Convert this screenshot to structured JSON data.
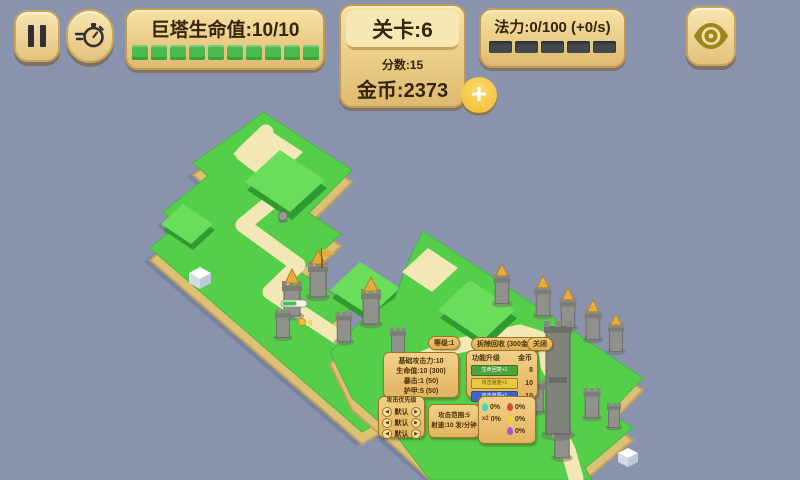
{
  "hud": {
    "tower_hp_label": "巨塔生命值:10/10",
    "level_label": "关卡:6",
    "score_label": "分数:15",
    "gold_label": "金币:2373",
    "mana_label": "法力:0/100 (+0/s)",
    "plus_glyph": "+"
  },
  "tooltip": {
    "level_pill": "等级:1",
    "demolish_label": "拆除回收 (300金币)",
    "close_label": "关闭",
    "stats": [
      "基础攻击力:10",
      "生命值:10 (300)",
      "暴击:1 (50)",
      "护甲:5 (50)"
    ],
    "upgrades": {
      "title": "功能升级",
      "cost_header": "金币",
      "items": [
        {
          "label": "生命回复+1",
          "cost": "8",
          "color": "#4CA53C"
        },
        {
          "label": "攻击速度+1",
          "cost": "10",
          "color": "#E8C93F"
        },
        {
          "label": "攻击范围+1",
          "cost": "10",
          "color": "#3E66C8"
        }
      ]
    },
    "priority": {
      "title": "攻击优先级",
      "rows": [
        "默认",
        "默认",
        "默认"
      ]
    },
    "range_lines": [
      "攻击范围:5",
      "射速:10 发/分钟"
    ],
    "effects": {
      "col1": [
        {
          "name": "ice",
          "prefix": "",
          "value": "0%"
        },
        {
          "name": "crit",
          "prefix": "x2",
          "value": "0%"
        }
      ],
      "col2": [
        {
          "name": "fire",
          "value": "0%"
        },
        {
          "name": "lightning",
          "value": "0%"
        },
        {
          "name": "poison",
          "value": "0%"
        }
      ]
    }
  },
  "map": {
    "floating_gold": "6"
  },
  "colors": {
    "background": "#8A93AE",
    "grass_top": "#55CE4A",
    "grass_raised": "#6ADE5A",
    "sand_path": "#F3E7B6",
    "cliff_sand": "#DCC077",
    "panel_gold": "#EDCF87",
    "hp_segment": "#4CBB4F",
    "mana_segment": "#43484E",
    "stone": "#90908C",
    "gold_roof": "#E3AC3F"
  }
}
